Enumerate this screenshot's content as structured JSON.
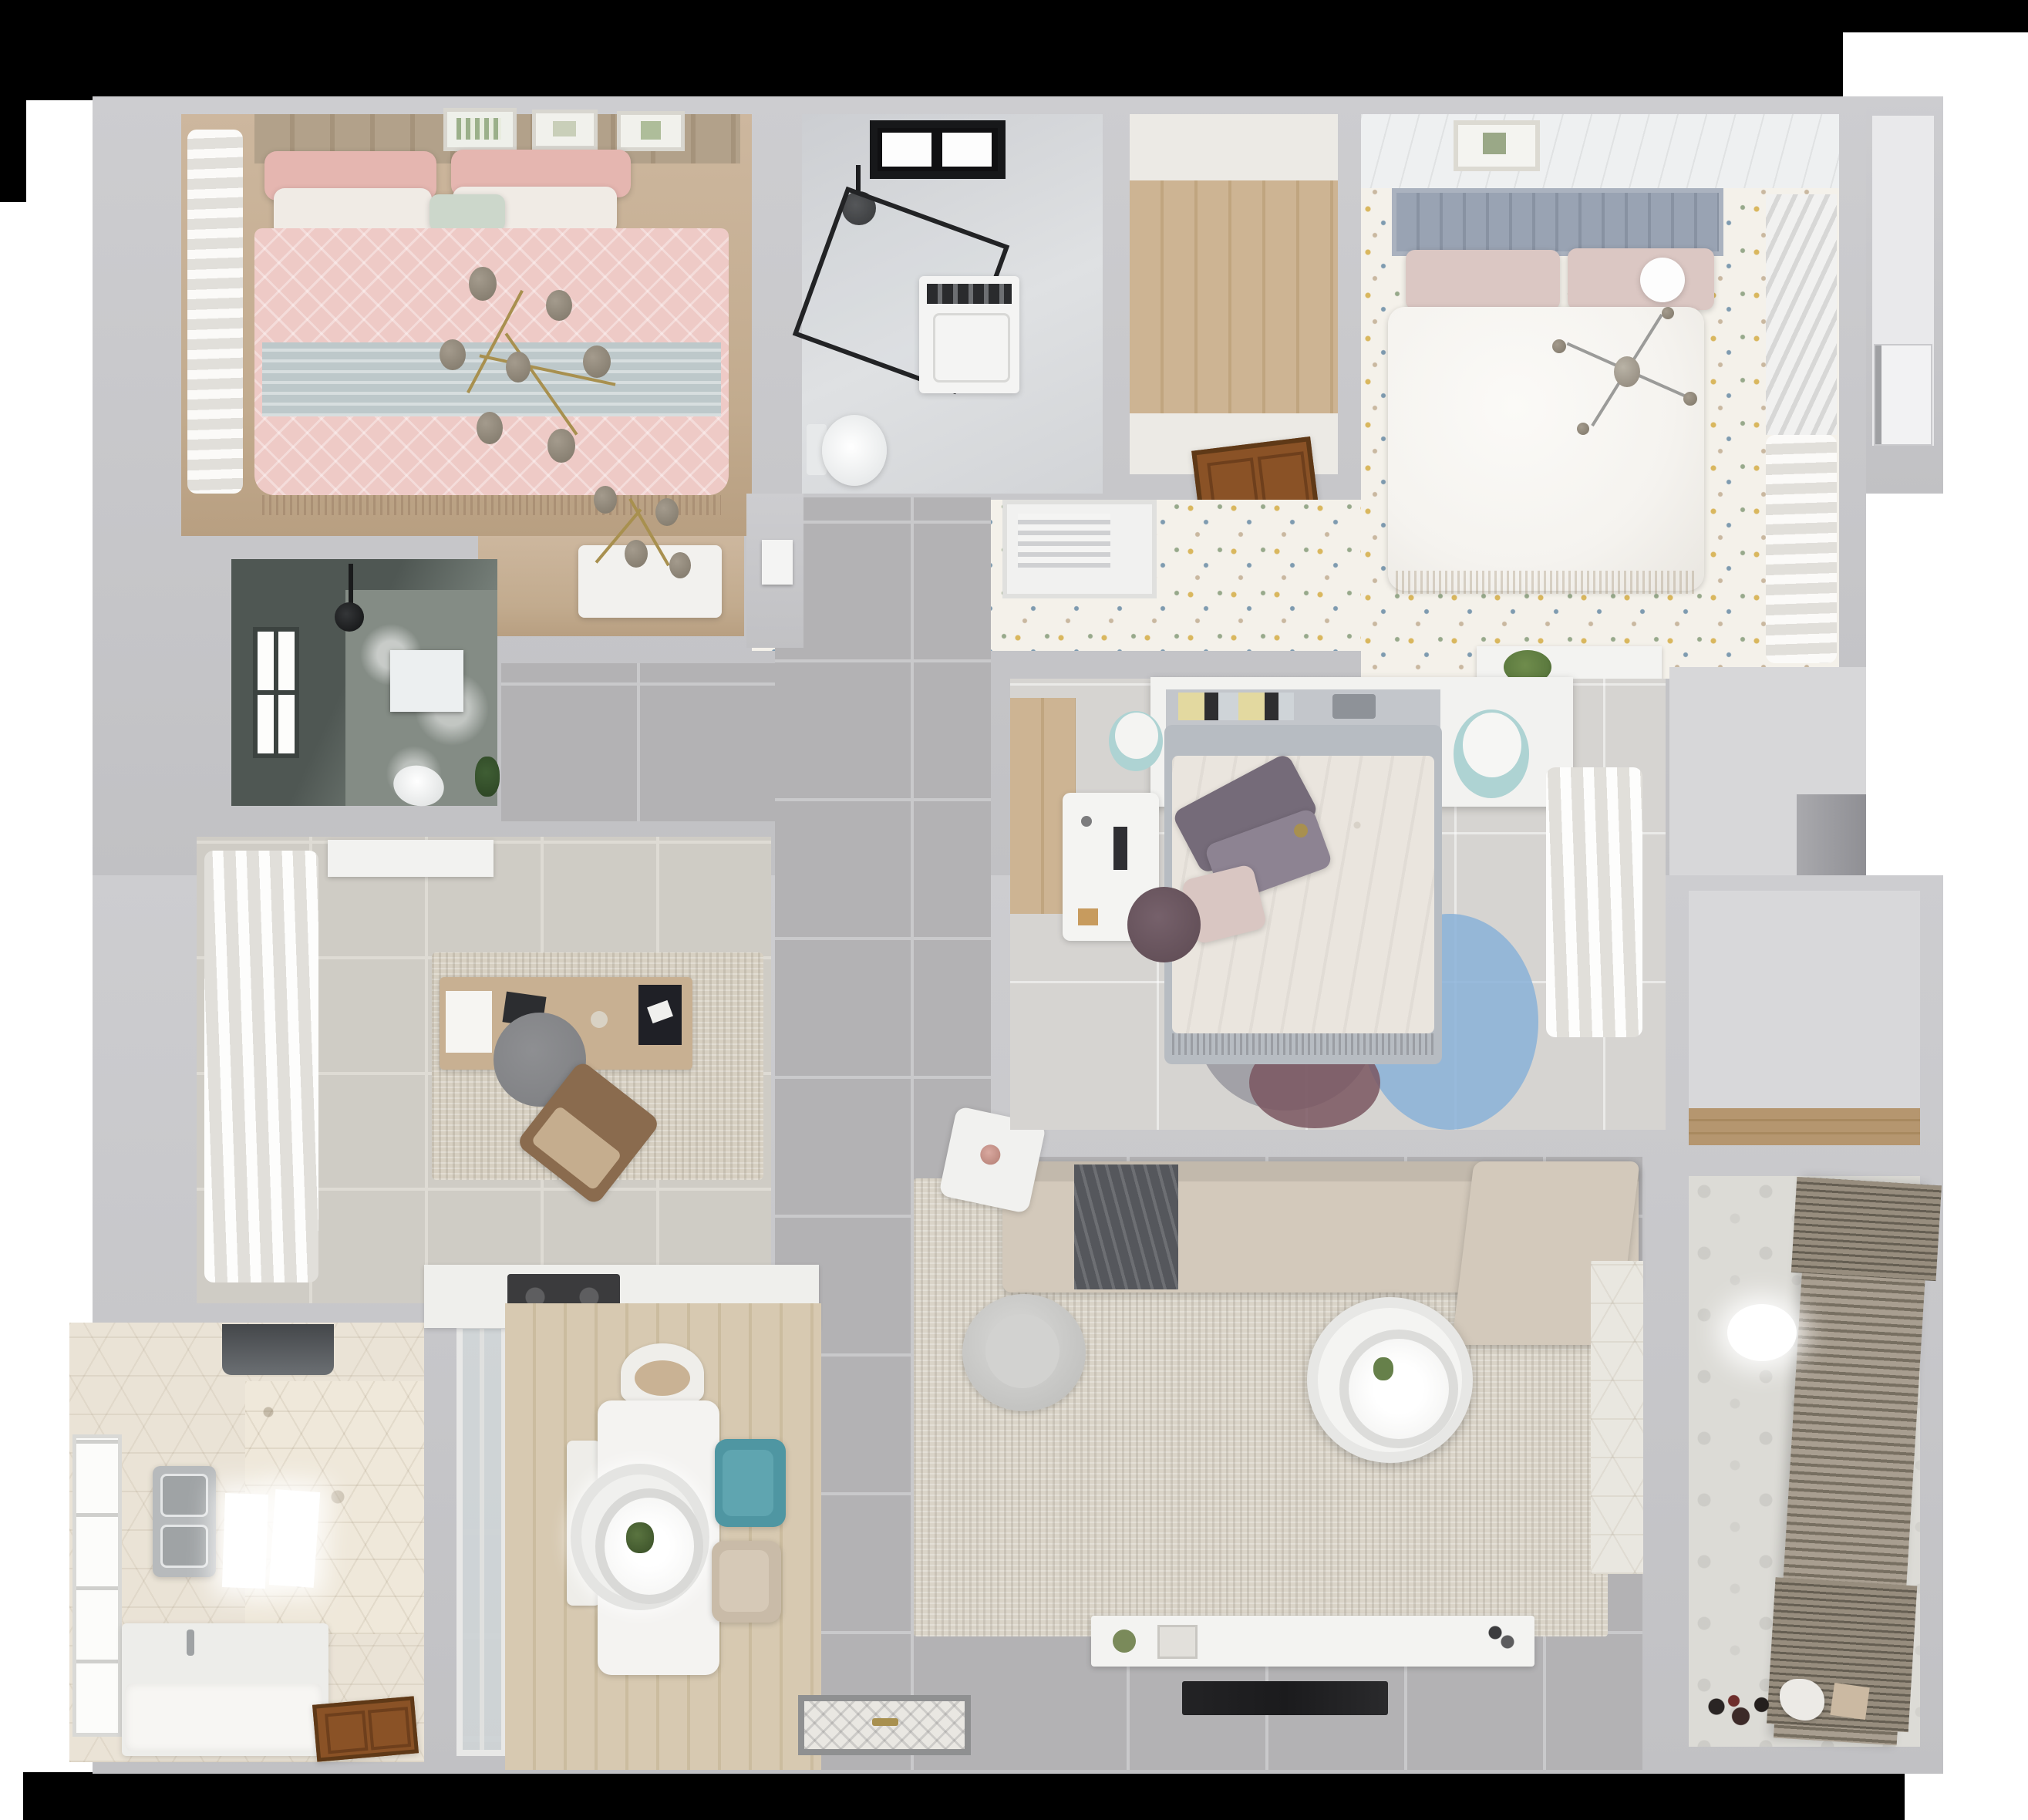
{
  "scene": {
    "title": "Apartment floor plan - photorealistic top-down 3D render",
    "view": "dollhouse top view",
    "letterboxed": true,
    "visible_text": "none"
  },
  "palette": {
    "black": "#000000",
    "white": "#ffffff",
    "wall": "#c9c9cc",
    "tileGray": "#b3b2b4",
    "grout": "#c9c9cb",
    "tileStudy": "#cfccc5",
    "groutStudy": "#dedbd4",
    "marbleA": "#ccced2",
    "marbleB": "#dfe1e3",
    "floralBase": "#f4f1ea",
    "woodPlank": "#cdb493",
    "woodPlankDark": "#c0a57f",
    "woodDining": "#d7c9b1",
    "woodShelf": "#b5966f",
    "doorBrown": "#8a5226",
    "doorBrownDark": "#5f3917",
    "pinkDuvet": "#eecac6",
    "pinkPillow": "#e5b6b0",
    "whitePillow": "#f0ebe5",
    "mintPillow": "#ccd7cb",
    "blueThrow": "#bdc8ca",
    "headboardTan": "#b2a18a",
    "gold": "#a8904f",
    "knob": "#8d8478",
    "curtainShade": "#e1dfda",
    "darkBath": "#59615c",
    "darkBathLight": "#8f978f",
    "bedWhite": "#f5f3ef",
    "headboardBlue": "#99a3b3",
    "blushPillow": "#dbc7c3",
    "duvetCream": "#eae5de",
    "purpleA": "#756b79",
    "purpleB": "#8d8392",
    "teal": "#4f96a2",
    "stoolTeal": "#aed3d3",
    "rugBlue": "#8ab1d6",
    "rugGray": "#9a99a1",
    "rugMaroon": "#7a5660",
    "rugPlum": "#8a7390",
    "sofa": "#d3c9bb",
    "blanket": "#55575c",
    "livingRug": "#dad4c8",
    "hex": "#eae3d6",
    "balconyTile": "#dcdbd6",
    "blind": "#a89e90",
    "blindDark": "#776f61",
    "counter": "#efefec",
    "cooktop": "#3b3b3d",
    "sink": "#b7babc",
    "mat": "#e9e7e2",
    "matBorder": "#8f9091",
    "plant": "#5c7a3f",
    "tvBlack": "#1b1b1d",
    "deskWood": "#c8b092",
    "chairGray": "#828386",
    "chairBrown": "#8a6b4e",
    "chairDarkPlum": "#5d4a52",
    "vent": "#f1f1f0"
  },
  "rooms": {
    "bedroom_pink": {
      "label": "Bedroom with pink bedding (top left)"
    },
    "bathroom_main": {
      "label": "Main bathroom with glass shower (top middle)"
    },
    "closet": {
      "label": "Utility room with wood floor (top middle-right)"
    },
    "bedroom_master": {
      "label": "Master bedroom on floral-speckled floor (top right)"
    },
    "hall_entry_top": {
      "label": "Entry hall with white door (top right edge)"
    },
    "bathroom_dark": {
      "label": "Dark-tiled shower room (middle left)"
    },
    "vanity_nook": {
      "label": "Vanity nook with brass chandelier"
    },
    "corridor": {
      "label": "Corridor with gray floor tiles"
    },
    "hallway": {
      "label": "Central hallway with large gray tiles"
    },
    "study": {
      "label": "Study with desk and sheer curtains (middle left)"
    },
    "kitchen": {
      "label": "Kitchen with hexagonal tile floor (bottom left)"
    },
    "glass_partition": {
      "label": "Glazed partition between kitchen and dining"
    },
    "kitchen_counter": {
      "label": "Kitchen counter with dark cooktop"
    },
    "dining": {
      "label": "Dining area with round pendant lamp"
    },
    "entry": {
      "label": "Entrance with ornamental doormat"
    },
    "living": {
      "label": "Living room with L-shaped sofa (bottom right)"
    },
    "bedroom_middle": {
      "label": "Middle bedroom with floral duvet and round rug"
    },
    "walk_in": {
      "label": "Walk-in area beside middle bedroom"
    },
    "storage": {
      "label": "Storage room with wooden shelf (right)"
    },
    "balcony": {
      "label": "Balcony / laundry with venetian blinds (bottom right)"
    }
  },
  "furniture": {
    "bedroom_pink": [
      "Double bed with pink patterned duvet",
      "Brass branch chandelier",
      "Sheer curtain along window wall",
      "Three botanical wall frames",
      "Light-blue folded throw",
      "Vanity table"
    ],
    "bathroom_main": [
      "Black-framed window",
      "Walk-in shower with black glass frame",
      "Washing machine",
      "Toilet",
      "Black rain shower head"
    ],
    "closet": [
      "Open brown wooden door"
    ],
    "bedroom_master": [
      "Blue-gray tufted headboard",
      "White double bed",
      "Blush pillows",
      "Gray sputnik chandelier",
      "Louvered wardrobe",
      "Console with green plant",
      "Sheer curtain"
    ],
    "bathroom_dark": [
      "Bright window",
      "Black shower fixture",
      "Wall niche",
      "Toilet",
      "Green plant"
    ],
    "study": [
      "White sheer curtains",
      "Wooden desk with laptop",
      "Gray swivel chair",
      "Brown lounge chair",
      "Mottled beige rug",
      "Dark doormat",
      "White wall cabinet"
    ],
    "kitchen": [
      "Range hood",
      "Double stainless sink",
      "Ceiling light reflections",
      "White counter with basin block",
      "Patterned hexagon accent wall",
      "Brown wooden door",
      "Bright window"
    ],
    "dining": [
      "White rectangular dining table",
      "Round tiered pendant lamp",
      "Teal chair",
      "Beige chair",
      "Curved-back chair",
      "White bench"
    ],
    "living": [
      "L-shaped beige sofa with dark gray blanket",
      "Large beige rug",
      "Round white coffee table",
      "Gray armchair",
      "White tilted side table",
      "TV console with decor",
      "Wall-mounted TV (black)",
      "Hexagon tile strip at balcony door"
    ],
    "bedroom_middle": [
      "White headboard shelf with books",
      "Bed with cream floral duvet",
      "Purple pillows",
      "Round layered rug (blue, gray, maroon)",
      "White desk with chair",
      "Two round stools",
      "Sheer curtain"
    ],
    "storage": [
      "Wooden shelf counter"
    ],
    "balcony": [
      "Venetian blinds",
      "Ceiling light",
      "Scattered toys and laundry items"
    ],
    "entry": [
      "Ornamental doormat with brass handles"
    ]
  }
}
